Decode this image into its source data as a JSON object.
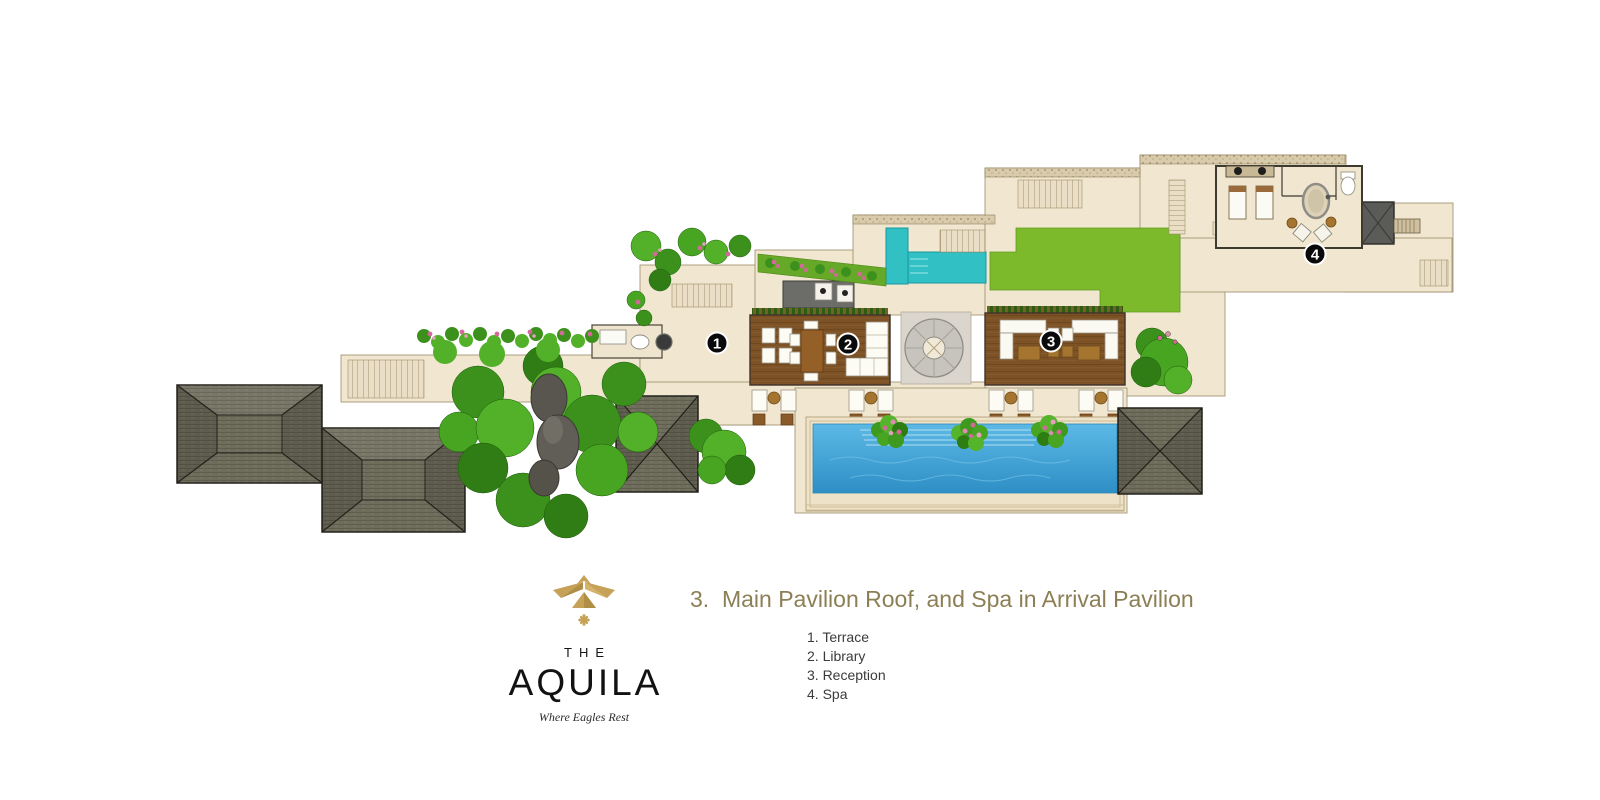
{
  "page": {
    "background": "#ffffff"
  },
  "plan": {
    "description": "Villa roof plan: main pavilion roofs, pools, gardens and spa in arrival pavilion",
    "markers": [
      {
        "number": "1",
        "label": "Terrace"
      },
      {
        "number": "2",
        "label": "Library"
      },
      {
        "number": "3",
        "label": "Reception"
      },
      {
        "number": "4",
        "label": "Spa"
      }
    ],
    "palette": {
      "terrace_beige": "#f1e7d1",
      "stone_edge": "#d8cbac",
      "roof_shingle": "#6e6c5b",
      "spa_roof_dark": "#5b5b57",
      "wood_deck": "#7d5226",
      "pool_blue": "#3a9ed4",
      "plunge_teal": "#31c1c5",
      "lawn_green": "#7cba2c",
      "tree_green": "#3c911c",
      "flower_pink": "#d26a98",
      "marker_black": "#0a0a0a"
    }
  },
  "caption": {
    "title": "3.  Main Pavilion Roof, and Spa in Arrival Pavilion",
    "title_color": "#8c7f55",
    "legend": {
      "items": [
        {
          "text": "1. Terrace"
        },
        {
          "text": "2. Library"
        },
        {
          "text": "3. Reception"
        },
        {
          "text": "4. Spa"
        }
      ]
    }
  },
  "logo": {
    "the": "THE",
    "name": "AQUILA",
    "tagline": "Where Eagles Rest",
    "gold": "#c5a258"
  }
}
